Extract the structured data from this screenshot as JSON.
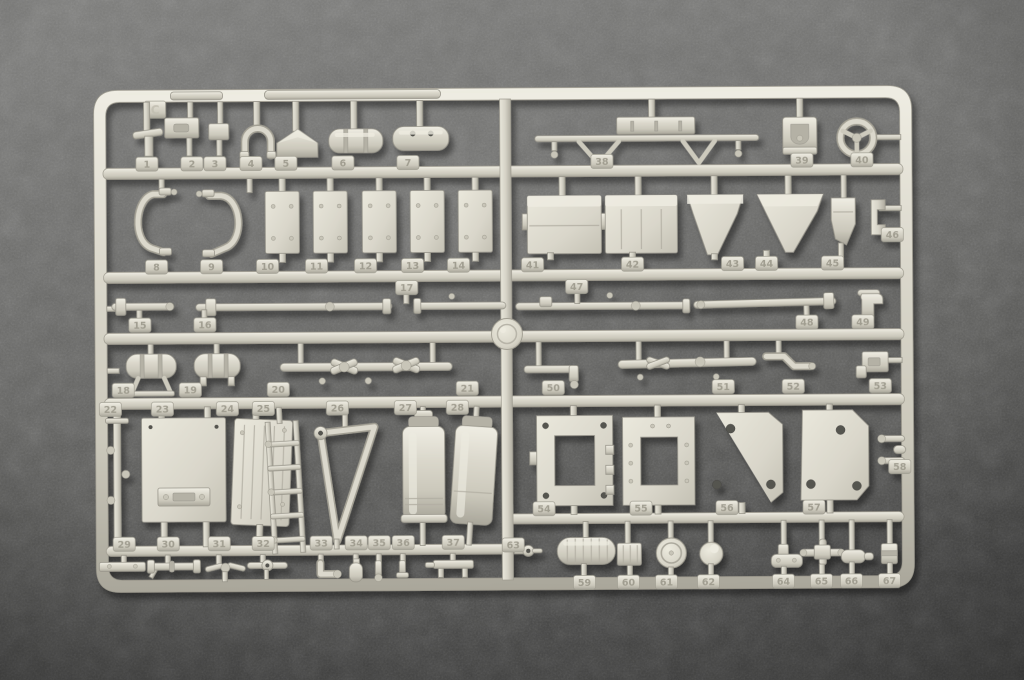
{
  "scene": {
    "type": "photograph",
    "subject": "Light grey injection-molded plastic model-kit parts sprue (runner) lying on a dark grey flocked surface",
    "sprue_letter": "C",
    "part_count": 67,
    "colors": {
      "plastic": "#d7d4c8",
      "plastic_highlight": "#edebe0",
      "plastic_shadow": "#a29f93",
      "background": "#6a6a68",
      "background_dark": "#474746"
    },
    "part_tags": [
      {
        "label": "1",
        "x": 137,
        "y": 155
      },
      {
        "label": "2",
        "x": 182,
        "y": 155
      },
      {
        "label": "3",
        "x": 205,
        "y": 155
      },
      {
        "label": "4",
        "x": 241,
        "y": 155
      },
      {
        "label": "5",
        "x": 276,
        "y": 155
      },
      {
        "label": "6",
        "x": 333,
        "y": 155
      },
      {
        "label": "7",
        "x": 398,
        "y": 155
      },
      {
        "label": "8",
        "x": 146,
        "y": 258
      },
      {
        "label": "9",
        "x": 201,
        "y": 258
      },
      {
        "label": "10",
        "x": 257,
        "y": 258
      },
      {
        "label": "11",
        "x": 306,
        "y": 258
      },
      {
        "label": "12",
        "x": 355,
        "y": 258
      },
      {
        "label": "13",
        "x": 402,
        "y": 258
      },
      {
        "label": "14",
        "x": 448,
        "y": 258
      },
      {
        "label": "15",
        "x": 129,
        "y": 316
      },
      {
        "label": "16",
        "x": 194,
        "y": 316
      },
      {
        "label": "17",
        "x": 396,
        "y": 280
      },
      {
        "label": "18",
        "x": 112,
        "y": 381
      },
      {
        "label": "19",
        "x": 179,
        "y": 381
      },
      {
        "label": "20",
        "x": 267,
        "y": 381
      },
      {
        "label": "21",
        "x": 456,
        "y": 381
      },
      {
        "label": "22",
        "x": 99,
        "y": 400
      },
      {
        "label": "23",
        "x": 151,
        "y": 400
      },
      {
        "label": "24",
        "x": 216,
        "y": 400
      },
      {
        "label": "25",
        "x": 252,
        "y": 400
      },
      {
        "label": "26",
        "x": 326,
        "y": 400
      },
      {
        "label": "27",
        "x": 394,
        "y": 400
      },
      {
        "label": "28",
        "x": 446,
        "y": 400
      },
      {
        "label": "29",
        "x": 112,
        "y": 535
      },
      {
        "label": "30",
        "x": 156,
        "y": 535
      },
      {
        "label": "31",
        "x": 207,
        "y": 535
      },
      {
        "label": "32",
        "x": 251,
        "y": 535
      },
      {
        "label": "33",
        "x": 309,
        "y": 535
      },
      {
        "label": "34",
        "x": 344,
        "y": 535
      },
      {
        "label": "35",
        "x": 367,
        "y": 535
      },
      {
        "label": "36",
        "x": 391,
        "y": 535
      },
      {
        "label": "37",
        "x": 441,
        "y": 535
      },
      {
        "label": "38",
        "x": 592,
        "y": 155
      },
      {
        "label": "39",
        "x": 792,
        "y": 155
      },
      {
        "label": "40",
        "x": 852,
        "y": 155
      },
      {
        "label": "41",
        "x": 522,
        "y": 258
      },
      {
        "label": "42",
        "x": 622,
        "y": 258
      },
      {
        "label": "43",
        "x": 722,
        "y": 258
      },
      {
        "label": "44",
        "x": 756,
        "y": 258
      },
      {
        "label": "45",
        "x": 822,
        "y": 258
      },
      {
        "label": "46",
        "x": 882,
        "y": 230
      },
      {
        "label": "47",
        "x": 566,
        "y": 280
      },
      {
        "label": "48",
        "x": 796,
        "y": 317
      },
      {
        "label": "49",
        "x": 852,
        "y": 317
      },
      {
        "label": "50",
        "x": 542,
        "y": 381
      },
      {
        "label": "51",
        "x": 712,
        "y": 381
      },
      {
        "label": "52",
        "x": 782,
        "y": 381
      },
      {
        "label": "53",
        "x": 869,
        "y": 381
      },
      {
        "label": "54",
        "x": 532,
        "y": 502
      },
      {
        "label": "55",
        "x": 629,
        "y": 502
      },
      {
        "label": "56",
        "x": 715,
        "y": 502
      },
      {
        "label": "57",
        "x": 802,
        "y": 502
      },
      {
        "label": "58",
        "x": 888,
        "y": 462
      },
      {
        "label": "59",
        "x": 572,
        "y": 576
      },
      {
        "label": "60",
        "x": 616,
        "y": 576
      },
      {
        "label": "61",
        "x": 654,
        "y": 576
      },
      {
        "label": "62",
        "x": 696,
        "y": 576
      },
      {
        "label": "63",
        "x": 501,
        "y": 538
      },
      {
        "label": "64",
        "x": 771,
        "y": 576
      },
      {
        "label": "65",
        "x": 809,
        "y": 576
      },
      {
        "label": "66",
        "x": 839,
        "y": 576
      },
      {
        "label": "67",
        "x": 877,
        "y": 576
      }
    ]
  }
}
